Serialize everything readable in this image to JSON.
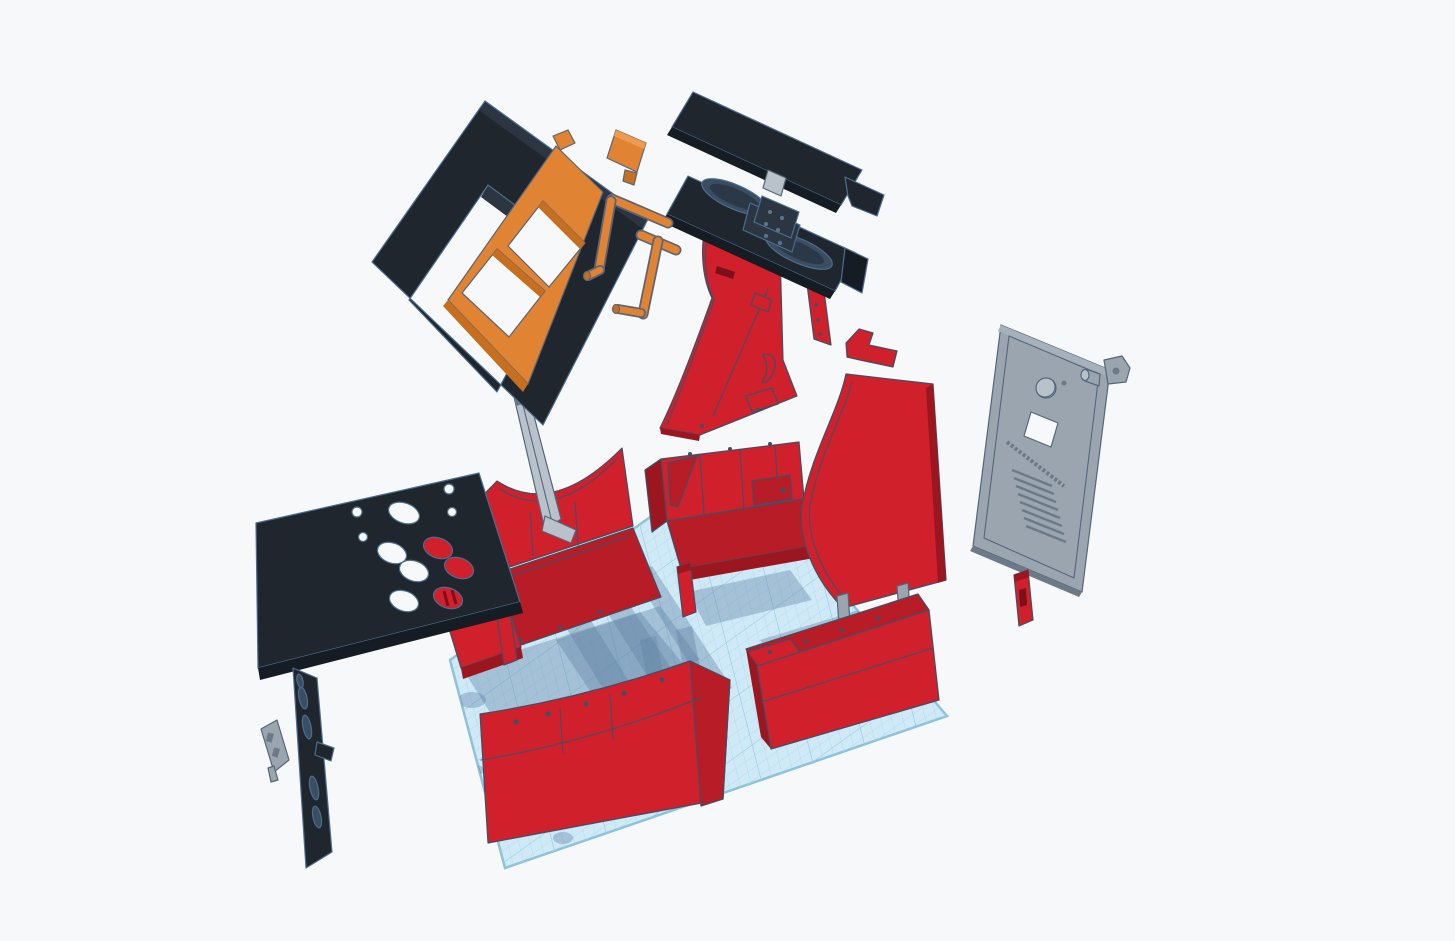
{
  "canvas": {
    "width": 1455,
    "height": 941,
    "kind": "3d-design-viewport"
  },
  "colors": {
    "bg": "#f7f8f9",
    "plane": "#cfe9f7",
    "planeGrid": "#abd8ec",
    "planeGridMajor": "#93c9e2",
    "planeEdge": "#8fc2da",
    "shadow": "#5f82a4",
    "red": "#cf202b",
    "redMid": "#b81c26",
    "redDark": "#9c1620",
    "redDeep": "#7c1019",
    "black": "#20262e",
    "blackDark": "#161c24",
    "blackFace": "#2b3642",
    "ovalRecess": "#3a4d61",
    "ovalRecessDeep": "#2a3847",
    "orange": "#e08332",
    "orangeDark": "#c76f1f",
    "orangeLight": "#f09a4e",
    "gray": "#9aa5af",
    "grayLight": "#b9c2ca",
    "grayDark": "#6c7a88",
    "outline": "#3f4f66",
    "outlineLight": "#4c6d90",
    "orangeOutline": "#5c6478",
    "grayOutline": "#55667a"
  },
  "workplane": {
    "visible": true,
    "grid": true,
    "shadows": true
  },
  "parts": [
    "screen-bezel",
    "monitor-frame",
    "monitor-bracket",
    "small-bracket-orange",
    "marquee",
    "speaker-panel",
    "upper-side-panel",
    "side-panel-right",
    "back-door",
    "lock-barrel",
    "lock-plate",
    "small-panel",
    "control-panel",
    "joystick-panel",
    "small-bracket-gray",
    "support-strut",
    "cabinet-base-left",
    "cabinet-base-mid",
    "cabinet-base-right",
    "front-panel",
    "post"
  ]
}
